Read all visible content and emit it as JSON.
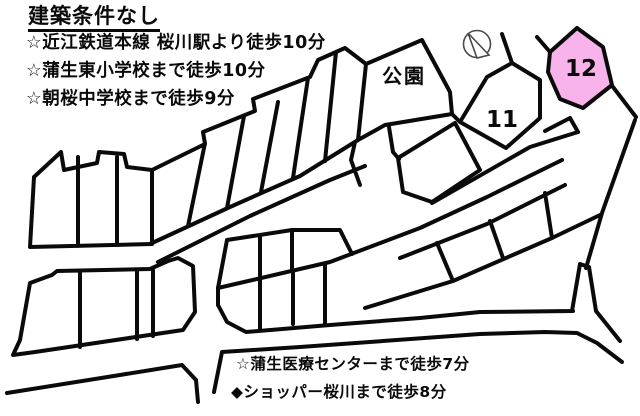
{
  "title": "建築条件なし",
  "features": [
    "☆近江鉄道本線 桜川駅より徒歩10分",
    "☆蒲生東小学校まで徒歩10分",
    "☆朝桜中学校まで徒歩9分"
  ],
  "map": {
    "park_label": "公園",
    "lot11_label": "11",
    "lot12_label": "12",
    "highlight_color": "#f7b3ea",
    "line_color": "#0a0a0a",
    "compass_icon": "compass-icon"
  },
  "footer_notes": [
    "☆蒲生医療センターまで徒歩7分",
    "◆ショッパー桜川まで徒歩8分"
  ]
}
